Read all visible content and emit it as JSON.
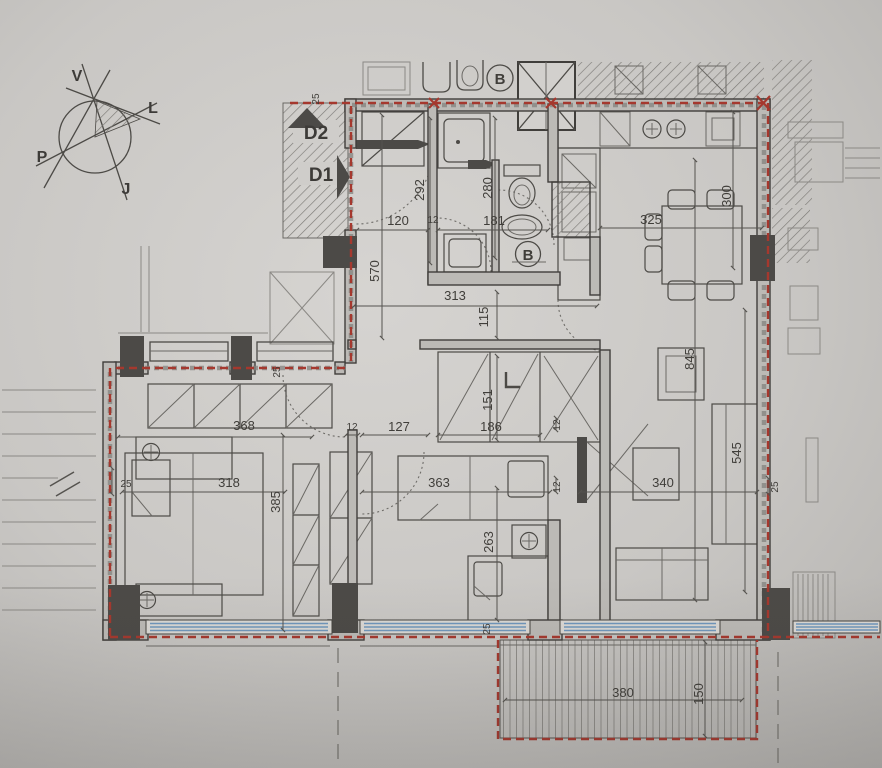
{
  "plan": {
    "compass": {
      "n": "V",
      "e": "L",
      "w": "P",
      "s": "J"
    },
    "doors": {
      "d2": "D2",
      "d1": "D1"
    },
    "badges": {
      "b_top": "B",
      "b_hall": "B"
    },
    "dims": {
      "t25": "25",
      "hall_h": "292",
      "hall_w": "120",
      "hall_d12": "12",
      "wc_w": "181",
      "wc_h": "280",
      "corridor_h": "570",
      "corridor_w": "313",
      "pass_115": "115",
      "kitchen_w": "325",
      "kitchen_h": "300",
      "closet_151": "151",
      "closet_186": "186",
      "corridor_127": "127",
      "w12_a": "12",
      "ward_368": "368",
      "win25_a": "25",
      "bed1_318": "318",
      "bed1_385": "385",
      "left25": "25",
      "bed2_363": "363",
      "bed2_263": "263",
      "w12_b": "12",
      "w12_c": "12",
      "living_845": "845",
      "living_545": "545",
      "living_340": "340",
      "right25": "25",
      "terr_380": "380",
      "terr_150": "150",
      "terr_25": "25"
    },
    "colors": {
      "boundary_red": "#a5382e",
      "glazing_blue": "#7097bc",
      "paper": "#c9c7c4",
      "ink": "#403e3b"
    }
  }
}
